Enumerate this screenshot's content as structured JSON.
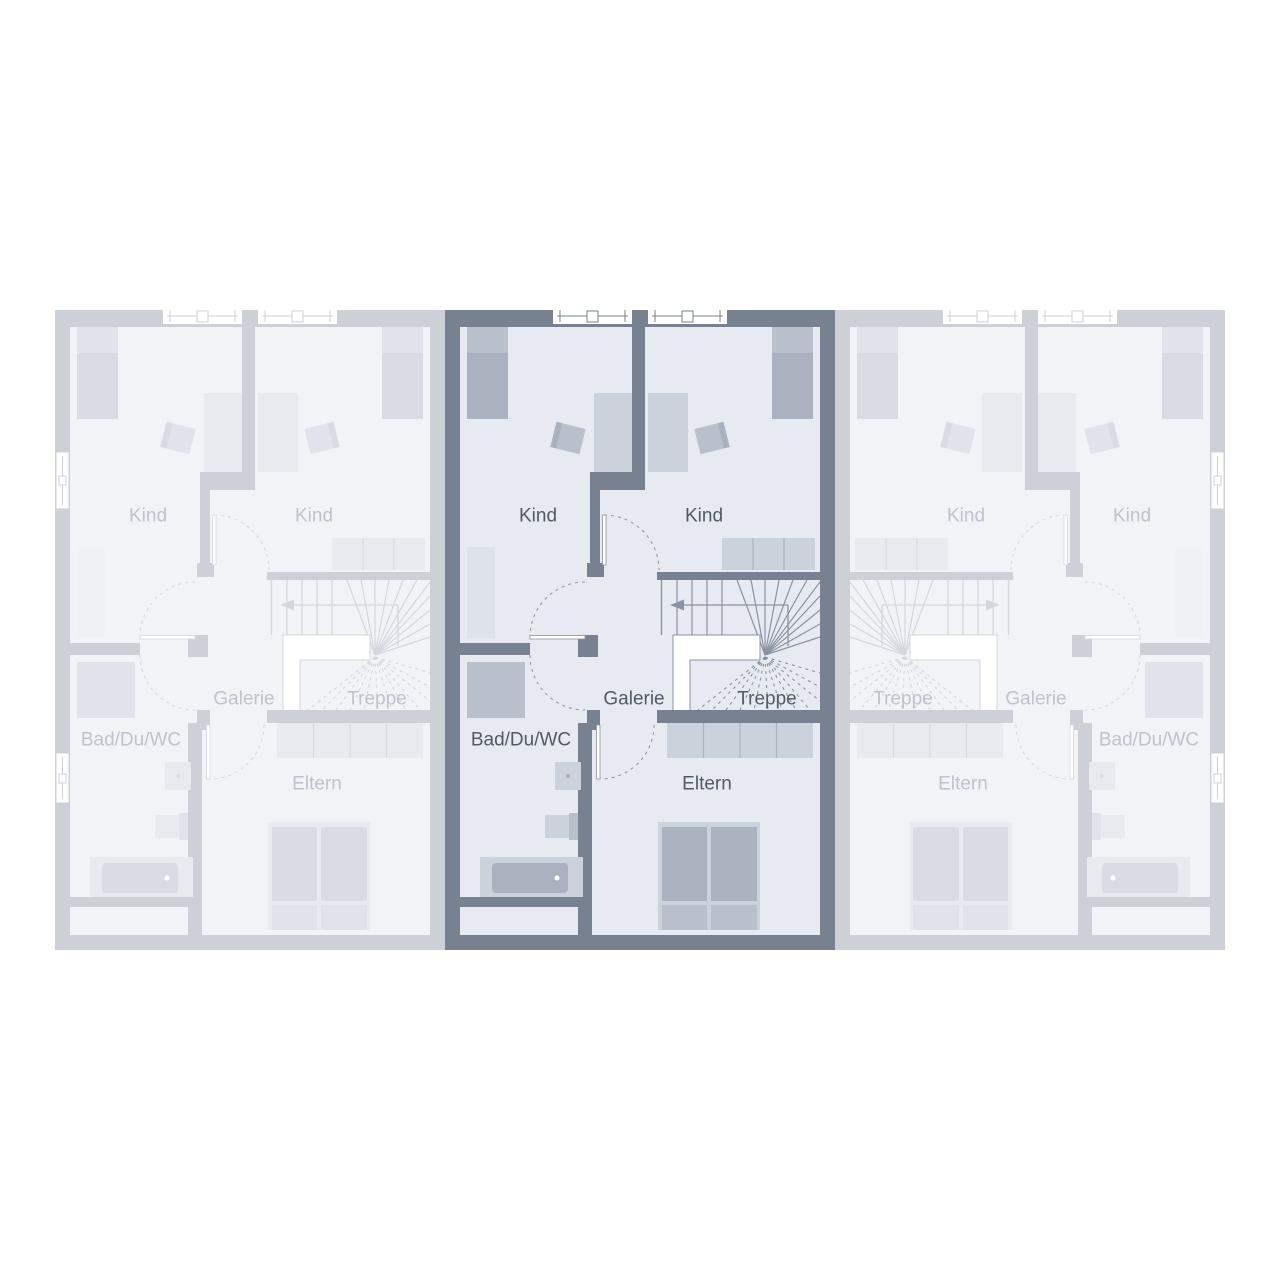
{
  "plan": {
    "type": "floor-plan",
    "description_labels_language": "de",
    "units": [
      {
        "id": "unit-left",
        "state": "inactive",
        "mirrored": false,
        "rooms": [
          {
            "name": "kind-left",
            "label": "Kind"
          },
          {
            "name": "kind-right",
            "label": "Kind"
          },
          {
            "name": "galerie",
            "label": "Galerie"
          },
          {
            "name": "treppe",
            "label": "Treppe"
          },
          {
            "name": "bad",
            "label": "Bad/Du/WC"
          },
          {
            "name": "eltern",
            "label": "Eltern"
          }
        ]
      },
      {
        "id": "unit-middle",
        "state": "active",
        "mirrored": false,
        "rooms": [
          {
            "name": "kind-left",
            "label": "Kind"
          },
          {
            "name": "kind-right",
            "label": "Kind"
          },
          {
            "name": "galerie",
            "label": "Galerie"
          },
          {
            "name": "treppe",
            "label": "Treppe"
          },
          {
            "name": "bad",
            "label": "Bad/Du/WC"
          },
          {
            "name": "eltern",
            "label": "Eltern"
          }
        ]
      },
      {
        "id": "unit-right",
        "state": "inactive",
        "mirrored": true,
        "rooms": [
          {
            "name": "kind-left",
            "label": "Kind"
          },
          {
            "name": "kind-right",
            "label": "Kind"
          },
          {
            "name": "galerie",
            "label": "Galerie"
          },
          {
            "name": "treppe",
            "label": "Treppe"
          },
          {
            "name": "bad",
            "label": "Bad/Du/WC"
          },
          {
            "name": "eltern",
            "label": "Eltern"
          }
        ]
      }
    ],
    "colors": {
      "background": "#ffffff",
      "active_wall": "#78818f",
      "active_room": "#e7ebf1",
      "active_furn_light": "#ccd2dc",
      "active_furn_mid": "#b9c0cb",
      "active_furn_dark": "#abb2bf",
      "active_furn_faint": "#dee2ea",
      "active_line": "#8a93a2",
      "active_label": "#525a68",
      "inactive_wall": "#cdd0d7",
      "inactive_room": "#f2f3f6",
      "inactive_furn_light": "#e8eaef",
      "inactive_furn_mid": "#e0e3e9",
      "inactive_furn_dark": "#d8dbe2",
      "inactive_furn_faint": "#eff1f4",
      "inactive_line": "#d4d7de",
      "inactive_label": "#bec3cd",
      "window_white": "#ffffff"
    }
  }
}
